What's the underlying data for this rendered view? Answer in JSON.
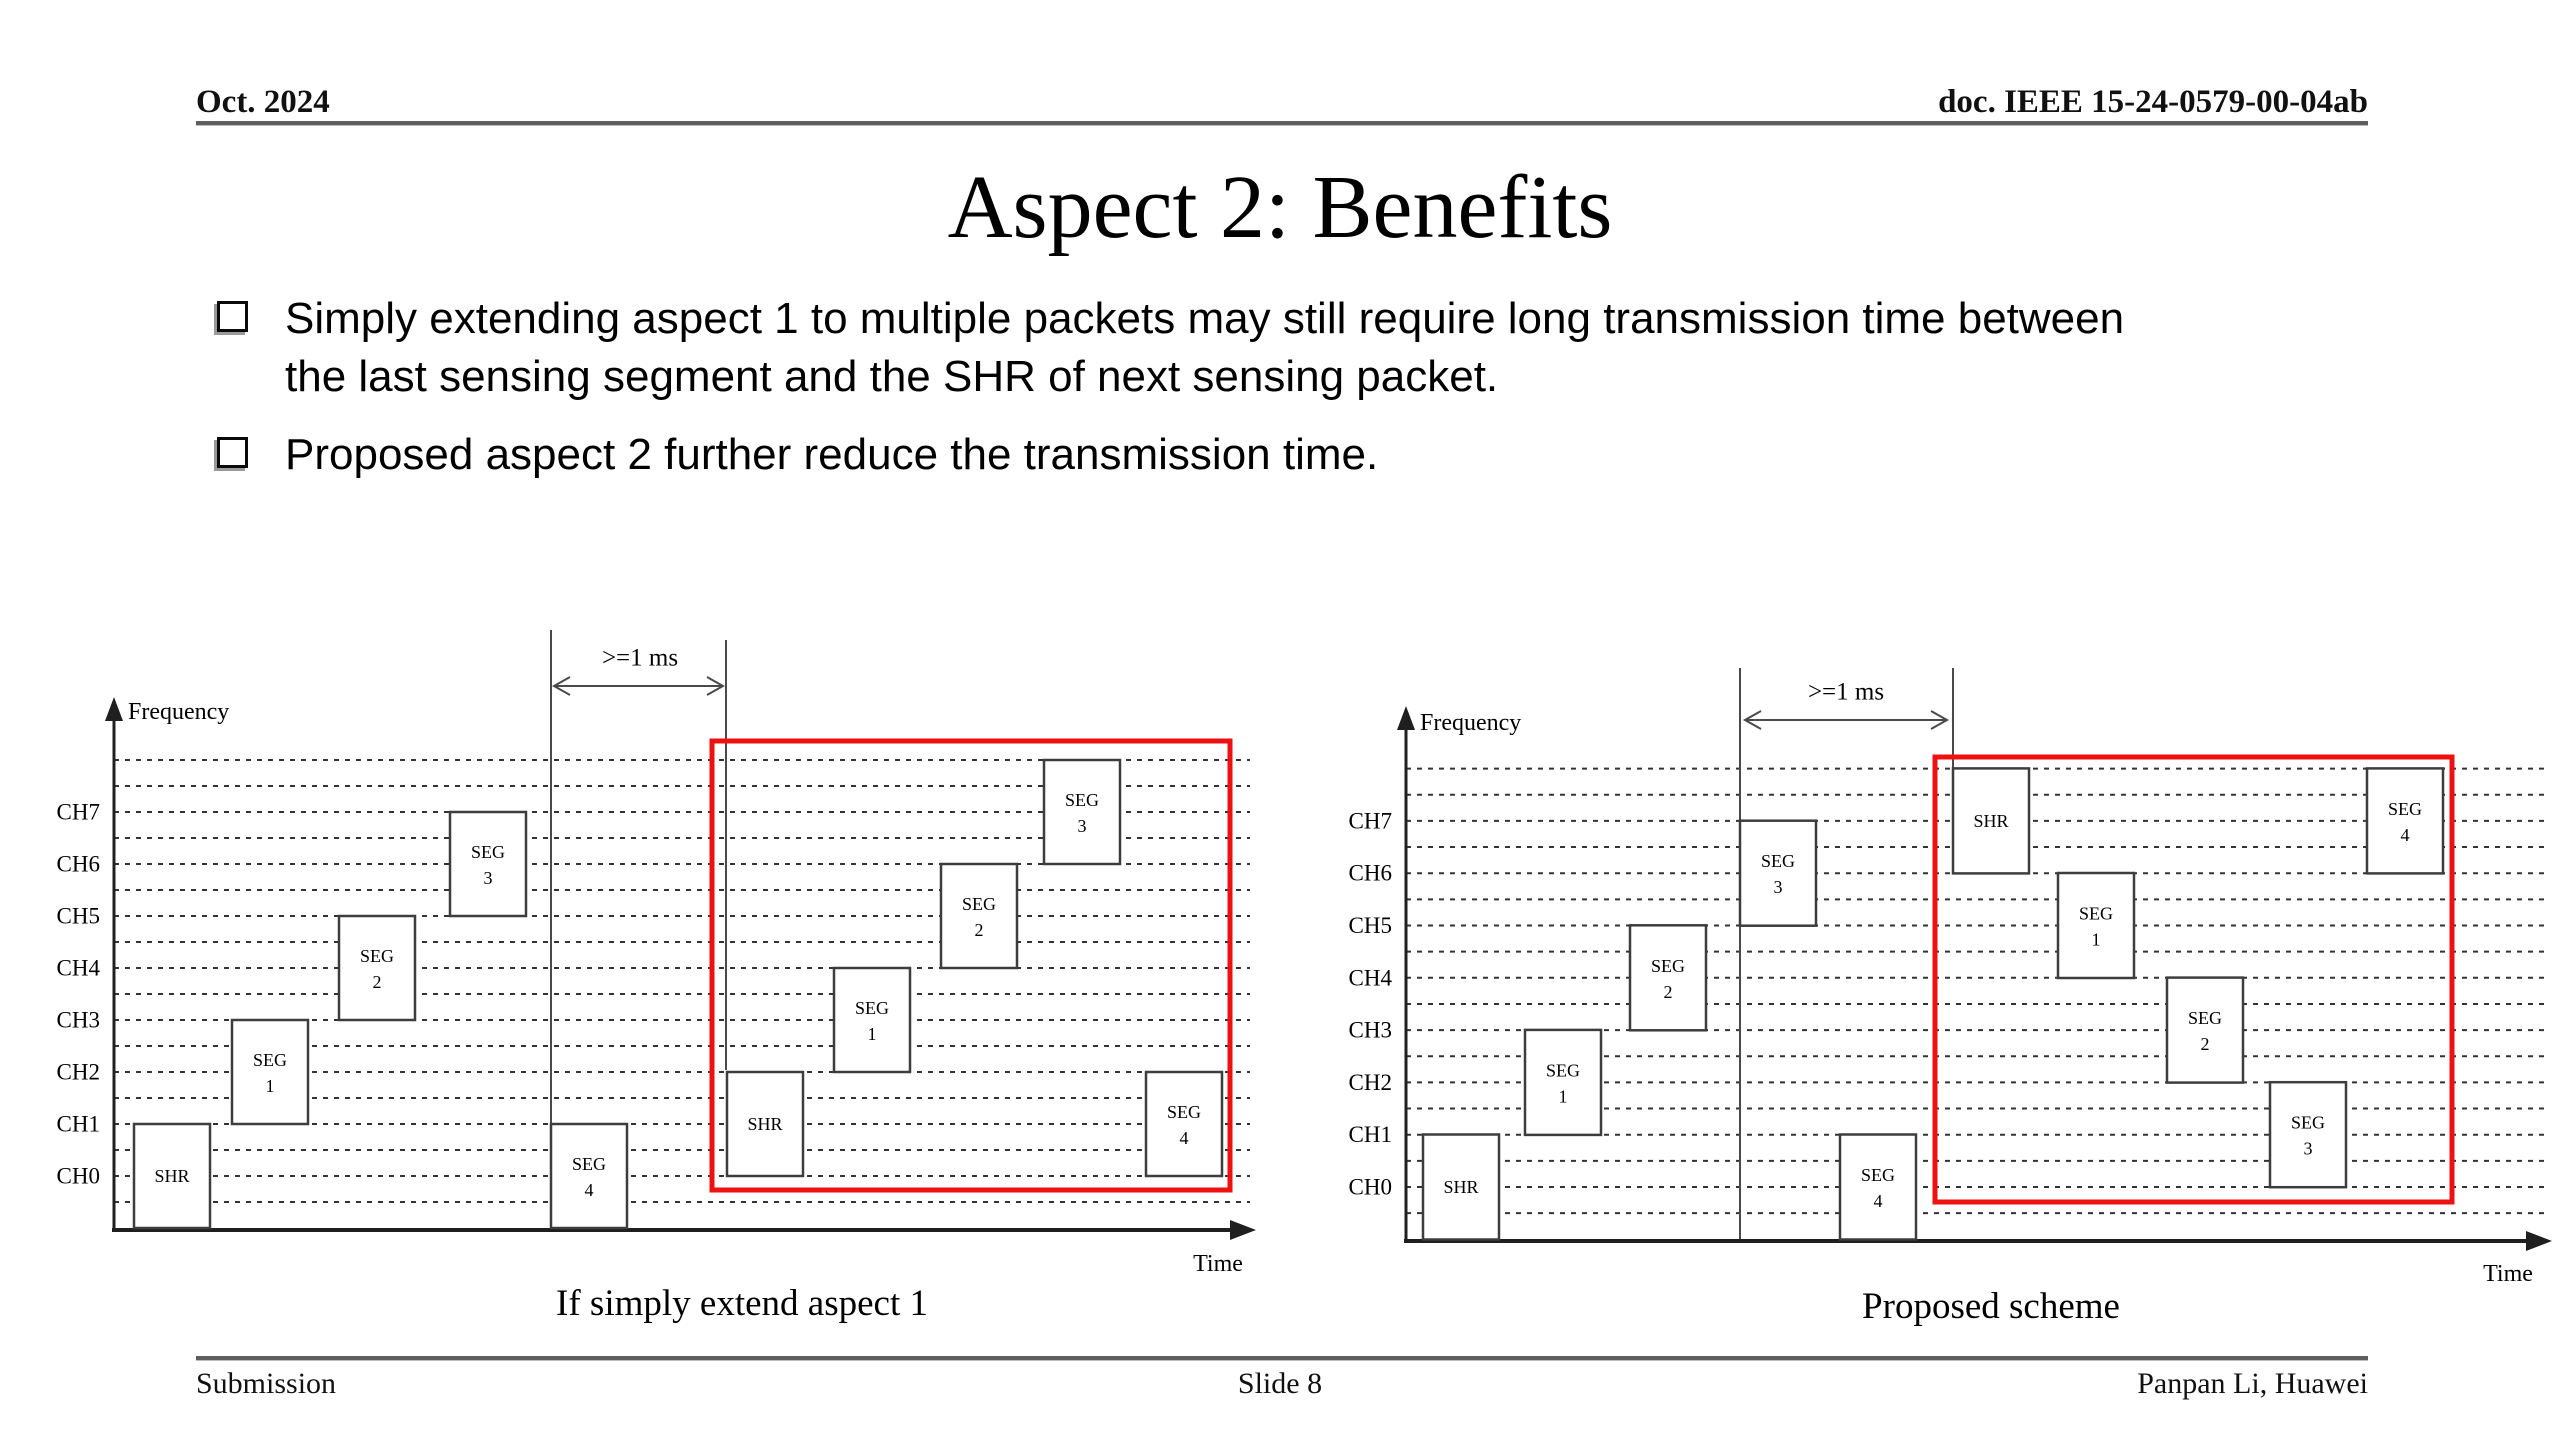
{
  "header": {
    "date": "Oct. 2024",
    "doc": "doc. IEEE 15-24-0579-00-04ab"
  },
  "title": "Aspect 2: Benefits",
  "bullets": [
    {
      "lines": [
        "Simply extending aspect 1 to multiple packets may still require long transmission time between",
        "the last sensing segment and the SHR of next sensing packet."
      ]
    },
    {
      "lines": [
        "Proposed aspect 2 further reduce the transmission time."
      ]
    }
  ],
  "footer": {
    "left": "Submission",
    "center": "Slide 8",
    "right": "Panpan Li, Huawei"
  },
  "colors": {
    "background": "#ffffff",
    "text": "#000000",
    "rule_gray": "#5f5f5f",
    "axis": "#1f1f1f",
    "dash": "#333333",
    "box_border": "#3d3d3d",
    "box_fill": "#ffffff",
    "thin_line": "#4a4a4a",
    "red_highlight": "#ee1111"
  },
  "diagrams": [
    {
      "id": "left",
      "caption": "If simply extend aspect 1",
      "freq_label": "Frequency",
      "time_label": "Time",
      "delay_label": ">=1 ms",
      "channel_names": [
        "CH0",
        "CH1",
        "CH2",
        "CH3",
        "CH4",
        "CH5",
        "CH6",
        "CH7"
      ],
      "geom": {
        "axis_x": 114,
        "axis_y": 1230,
        "x_end": 1256,
        "y_top": 697,
        "ch0_y": 1176,
        "ch_spacing": 52.0,
        "dash_x0": 114,
        "dash_x1": 1250,
        "box_w": 76,
        "box_h": 104,
        "freq_label_x": 128,
        "freq_label_y": 712,
        "time_label_x": 1218,
        "time_label_y": 1264,
        "vlines": [
          {
            "x": 551,
            "y0": 630,
            "y1": 1229
          },
          {
            "x": 726,
            "y0": 640,
            "y1": 1070
          }
        ],
        "delay": {
          "x0": 551,
          "x1": 726,
          "y": 686,
          "label_x": 640,
          "label_y": 658
        },
        "red_box": {
          "x0": 712,
          "y0": 741,
          "x1": 1230,
          "y1": 1190
        }
      },
      "boxes": [
        {
          "label": "SHR",
          "sub": "",
          "x": 134,
          "ch": 0
        },
        {
          "label": "SEG",
          "sub": "1",
          "x": 232,
          "ch": 2
        },
        {
          "label": "SEG",
          "sub": "2",
          "x": 339,
          "ch": 4
        },
        {
          "label": "SEG",
          "sub": "3",
          "x": 450,
          "ch": 6
        },
        {
          "label": "SEG",
          "sub": "4",
          "x": 551,
          "ch": 0
        },
        {
          "label": "SHR",
          "sub": "",
          "x": 727,
          "ch": 1
        },
        {
          "label": "SEG",
          "sub": "1",
          "x": 834,
          "ch": 3
        },
        {
          "label": "SEG",
          "sub": "2",
          "x": 941,
          "ch": 5
        },
        {
          "label": "SEG",
          "sub": "3",
          "x": 1044,
          "ch": 7
        },
        {
          "label": "SEG",
          "sub": "4",
          "x": 1146,
          "ch": 1
        }
      ]
    },
    {
      "id": "right",
      "caption": "Proposed scheme",
      "freq_label": "Frequency",
      "time_label": "Time",
      "delay_label": ">=1 ms",
      "channel_names": [
        "CH0",
        "CH1",
        "CH2",
        "CH3",
        "CH4",
        "CH5",
        "CH6",
        "CH7"
      ],
      "geom": {
        "axis_x": 1406,
        "axis_y": 1241,
        "x_end": 2552,
        "y_top": 706,
        "ch0_y": 1187,
        "ch_spacing": 52.3,
        "dash_x0": 1406,
        "dash_x1": 2546,
        "box_w": 76,
        "box_h": 105,
        "freq_label_x": 1420,
        "freq_label_y": 723,
        "time_label_x": 2508,
        "time_label_y": 1274,
        "vlines": [
          {
            "x": 1740,
            "y0": 668,
            "y1": 1240
          },
          {
            "x": 1953,
            "y0": 668,
            "y1": 772
          }
        ],
        "delay": {
          "x0": 1742,
          "x1": 1950,
          "y": 720,
          "label_x": 1846,
          "label_y": 692
        },
        "red_box": {
          "x0": 1935,
          "y0": 757,
          "x1": 2452,
          "y1": 1202
        }
      },
      "boxes": [
        {
          "label": "SHR",
          "sub": "",
          "x": 1423,
          "ch": 0
        },
        {
          "label": "SEG",
          "sub": "1",
          "x": 1525,
          "ch": 2
        },
        {
          "label": "SEG",
          "sub": "2",
          "x": 1630,
          "ch": 4
        },
        {
          "label": "SEG",
          "sub": "3",
          "x": 1740,
          "ch": 6
        },
        {
          "label": "SEG",
          "sub": "4",
          "x": 1840,
          "ch": 0
        },
        {
          "label": "SHR",
          "sub": "",
          "x": 1953,
          "ch": 7
        },
        {
          "label": "SEG",
          "sub": "1",
          "x": 2058,
          "ch": 5
        },
        {
          "label": "SEG",
          "sub": "2",
          "x": 2167,
          "ch": 3
        },
        {
          "label": "SEG",
          "sub": "3",
          "x": 2270,
          "ch": 1
        },
        {
          "label": "SEG",
          "sub": "4",
          "x": 2367,
          "ch": 7
        }
      ]
    }
  ]
}
